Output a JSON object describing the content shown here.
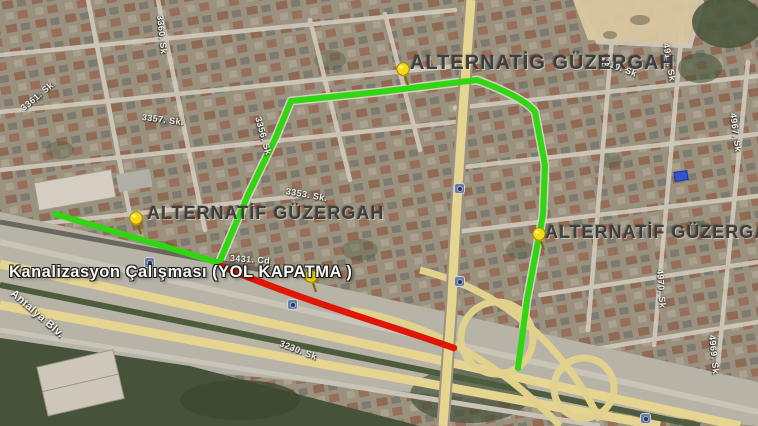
{
  "map": {
    "description": "Satellite map showing sewer-works road closure and alternative routes",
    "annotations": {
      "route_label_top": "ALTERNATİG GÜZERGAH",
      "route_label_left": "ALTERNATİF GÜZERGAH",
      "route_label_right": "ALTERNATİF GÜZERGAN",
      "closure_label": "Kanalizasyon Çalışması (YOL KAPATMA )"
    },
    "colors": {
      "alternative_route": "#2fd611",
      "closed_road": "#e01505",
      "pushpin": "#f6d90f",
      "road_badge": "#6e7b99"
    },
    "street_labels": [
      {
        "text": "3360. Sk",
        "x": 160,
        "y": 10,
        "rot": 84
      },
      {
        "text": "3361. Sk",
        "x": 22,
        "y": 104,
        "rot": -40
      },
      {
        "text": "3357. Sk.",
        "x": 142,
        "y": 112,
        "rot": 7
      },
      {
        "text": "3356. Sk",
        "x": 258,
        "y": 112,
        "rot": 74
      },
      {
        "text": "3353. Sk.",
        "x": 286,
        "y": 186,
        "rot": 10
      },
      {
        "text": "3431. Cd",
        "x": 230,
        "y": 253,
        "rot": 4
      },
      {
        "text": "4910. Sk",
        "x": 600,
        "y": 55,
        "rot": 21
      },
      {
        "text": "4911. Sk",
        "x": 666,
        "y": 38,
        "rot": 80
      },
      {
        "text": "4967. Sk",
        "x": 733,
        "y": 108,
        "rot": 82
      },
      {
        "text": "4970. Sk",
        "x": 660,
        "y": 264,
        "rot": 86
      },
      {
        "text": "4969. Sk",
        "x": 712,
        "y": 330,
        "rot": 84
      },
      {
        "text": "3230. Sk",
        "x": 280,
        "y": 338,
        "rot": 21
      },
      {
        "text": "Antalya Blv.",
        "x": 12,
        "y": 286,
        "rot": 41,
        "size": 11
      }
    ],
    "pushpins": [
      {
        "x": 403,
        "y": 69
      },
      {
        "x": 136,
        "y": 218
      },
      {
        "x": 539,
        "y": 234
      },
      {
        "x": 311,
        "y": 276
      }
    ],
    "road_badges": [
      {
        "x": 149,
        "y": 262
      },
      {
        "x": 292,
        "y": 304
      },
      {
        "x": 459,
        "y": 188
      },
      {
        "x": 459,
        "y": 281
      },
      {
        "x": 645,
        "y": 418
      }
    ],
    "blue_placemark": {
      "x": 680,
      "y": 175
    }
  }
}
